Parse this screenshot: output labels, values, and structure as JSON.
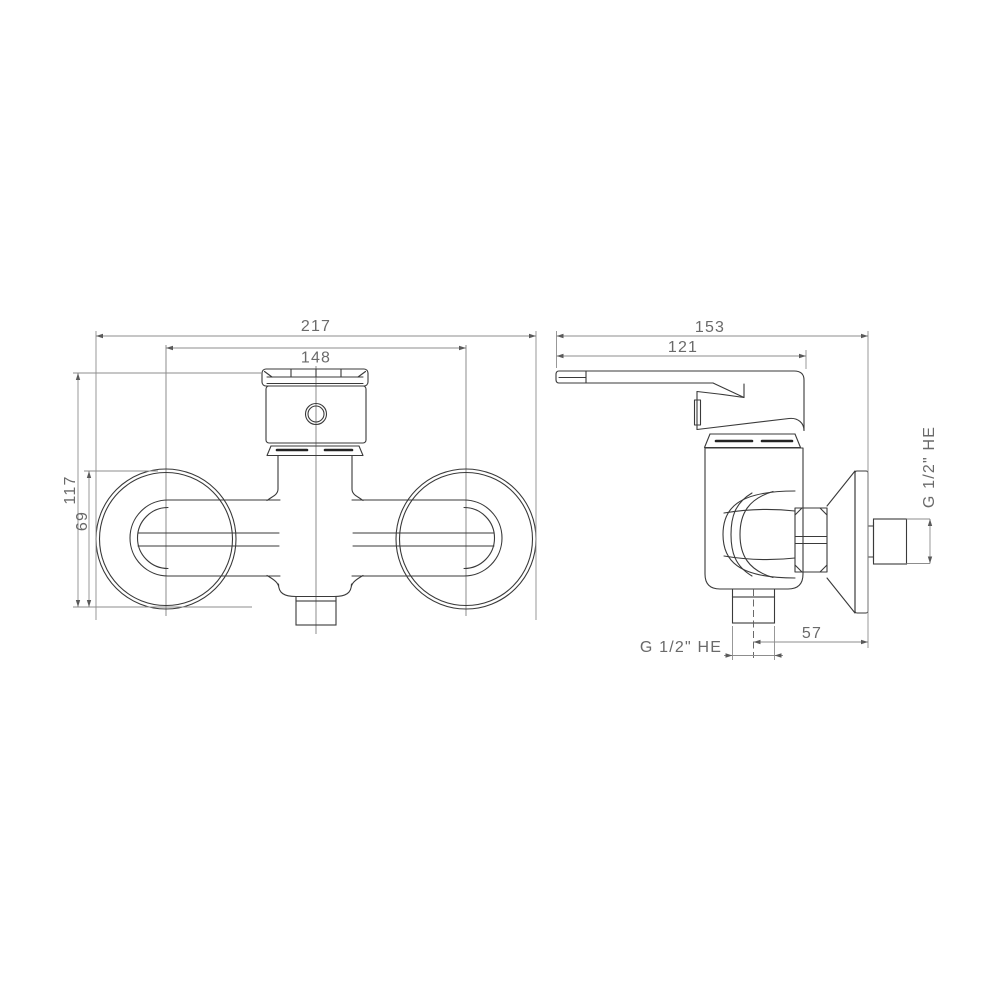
{
  "page": {
    "background": "#ffffff"
  },
  "colors": {
    "part_line": "#3a3a3a",
    "dimension_line": "#8d8d8d",
    "dimension_text": "#6a6a6a",
    "thread_fill": "#141414"
  },
  "views": {
    "front": {
      "dimensions": {
        "overall_width": "217",
        "connection_centers": "148",
        "overall_height": "117",
        "escutcheon_diameter": "69"
      }
    },
    "side": {
      "dimensions": {
        "overall_depth": "153",
        "handle_length": "121",
        "outlet_to_wall": "57",
        "wall_connection_thread": "G 1/2\" HE",
        "shower_outlet_thread": "G 1/2\" HE"
      }
    }
  }
}
